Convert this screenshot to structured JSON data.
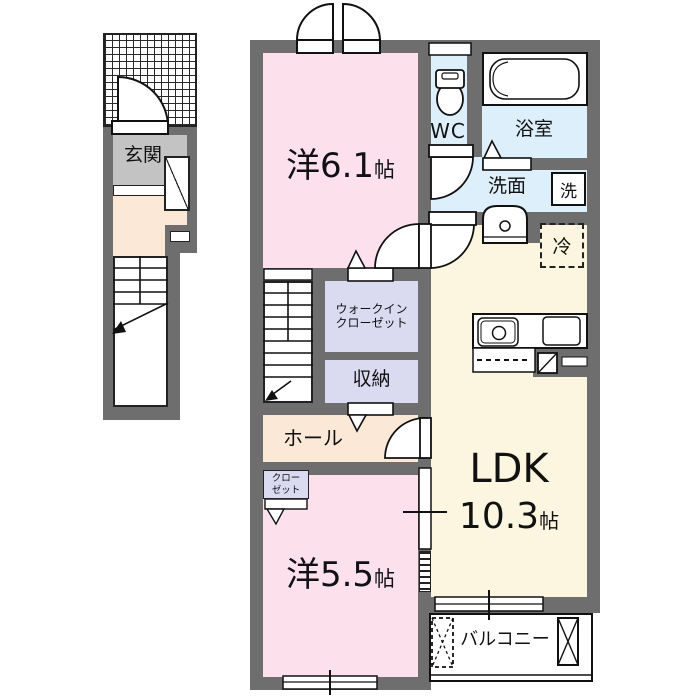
{
  "plan": {
    "type": "floor-plan",
    "labels": {
      "genkan": "玄関",
      "bedroom1": {
        "prefix": "洋",
        "size": "6.1",
        "unit": "帖"
      },
      "bedroom2": {
        "prefix": "洋",
        "size": "5.5",
        "unit": "帖"
      },
      "ldk": {
        "name": "LDK",
        "size": "10.3",
        "unit": "帖"
      },
      "wc": "WC",
      "bath": "浴室",
      "washroom": "洗面",
      "washer": "洗",
      "fridge": "冷",
      "walk_in_closet_line1": "ウォークイン",
      "walk_in_closet_line2": "クローゼット",
      "storage": "収納",
      "hall": "ホール",
      "closet_line1": "クロー",
      "closet_line2": "ゼット",
      "balcony": "バルコニー"
    },
    "colors": {
      "wall": "#6E6E6E",
      "room_pink": "#FCE1ED",
      "wet_blue": "#DCEFFA",
      "closet_lavender": "#DADAF0",
      "ldk_cream": "#FCF5DF",
      "hall_peach": "#FBE8D7",
      "genkan_gray": "#C3C3C3",
      "line": "#222222",
      "background": "#FFFFFF"
    }
  }
}
